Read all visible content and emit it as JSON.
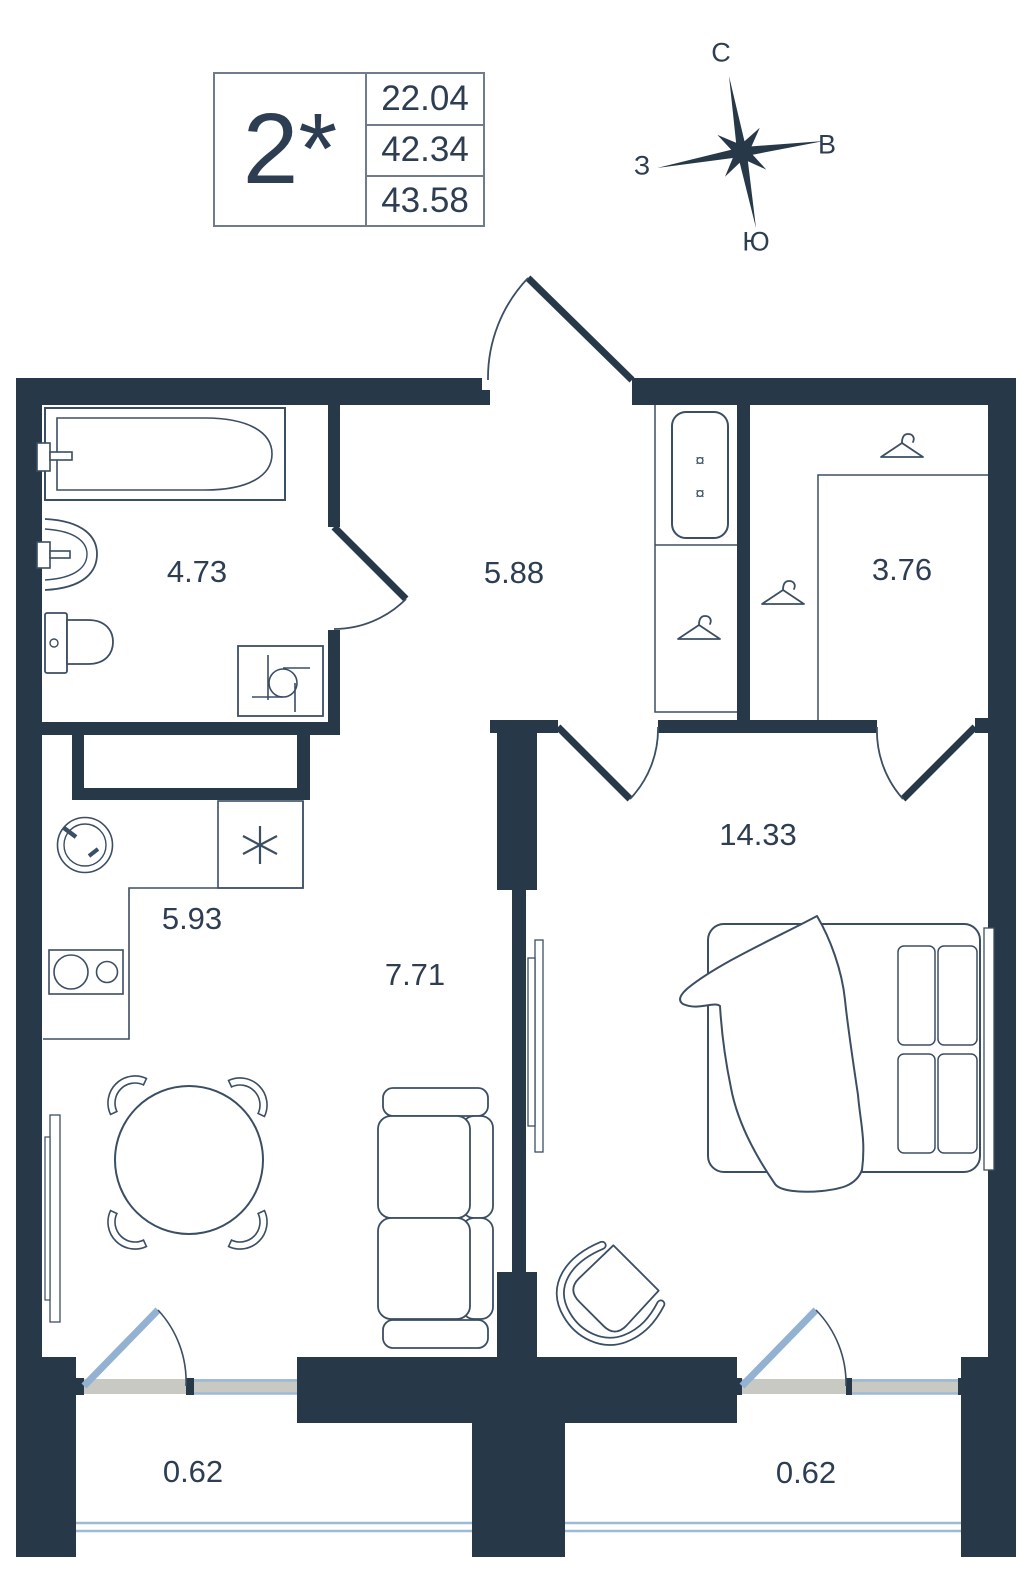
{
  "legend": {
    "rooms": "2*",
    "values": [
      "22.04",
      "42.34",
      "43.58"
    ]
  },
  "compass": {
    "north": "С",
    "east": "В",
    "west": "З",
    "south": "Ю"
  },
  "areas": {
    "bathroom": "4.73",
    "hallway": "5.88",
    "wardrobe": "3.76",
    "kitchen": "5.93",
    "living": "7.71",
    "bedroom": "14.33",
    "balcony_left": "0.62",
    "balcony_right": "0.62"
  },
  "icons": {
    "wardrobe_marker": "¤"
  },
  "colors": {
    "wall": "#273949",
    "furniture_line": "#3b4e63",
    "text": "#2d3e52",
    "glazing": "#9cb9d6",
    "balcony_door": "#93b2d2",
    "window_sill": "#c9c9c4"
  }
}
